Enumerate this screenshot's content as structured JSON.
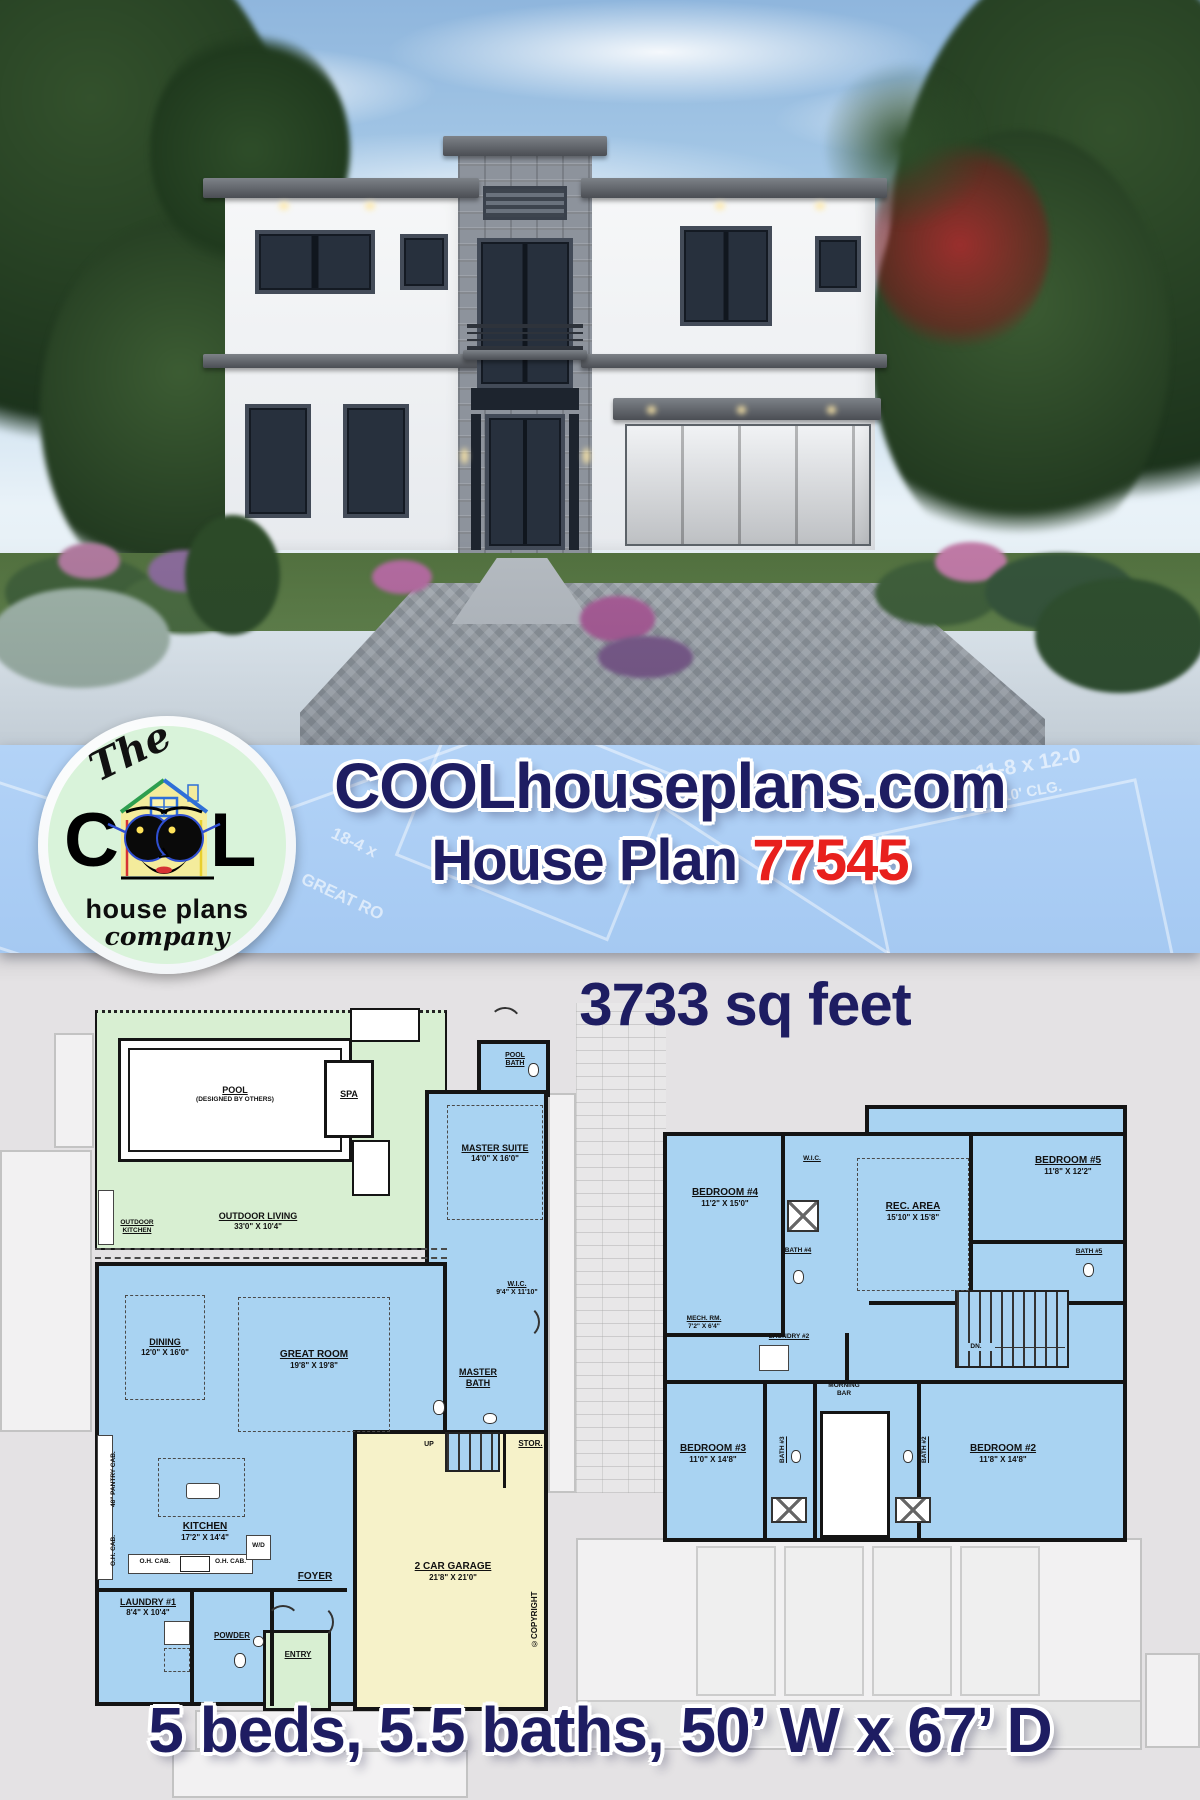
{
  "colors": {
    "navy": "#1e1d62",
    "red": "#e8201d",
    "banner_blue": "#a9ccf5",
    "room_blue": "#a9d3f2",
    "outdoor_green": "#d8efd2",
    "garage_yellow": "#f6f2c9",
    "background_gray": "#e2e0e2",
    "logo_green": "#d9f3da"
  },
  "banner": {
    "site_title": "COOLhouseplans.com",
    "plan_prefix": "House Plan",
    "plan_number": "77545",
    "logo": {
      "the": "The",
      "c": "C",
      "l": "L",
      "line2": "house plans",
      "line3": "company",
      "registered": "®"
    },
    "watermarks": [
      "11-8 x 12-0",
      "10' CLG.",
      "18-4 x",
      "HT.",
      "GREAT RO"
    ]
  },
  "plans": {
    "sqft": "3733 sq feet",
    "footer": "5 beds, 5.5 baths, 50’ W x 67’ D"
  },
  "floor1": {
    "pool": "POOL",
    "pool_note": "(DESIGNED BY OTHERS)",
    "spa": "SPA",
    "outdoor_kitchen_1": "OUTDOOR",
    "outdoor_kitchen_2": "KITCHEN",
    "outdoor_living": "OUTDOOR LIVING",
    "outdoor_living_dims": "33'0\" X 10'4\"",
    "master_suite": "MASTER SUITE",
    "master_suite_dims": "14'0\" X 16'0\"",
    "pool_bath_1": "POOL",
    "pool_bath_2": "BATH",
    "wic": "W.I.C.",
    "wic_dims": "9'4\" X 11'10\"",
    "master_bath_1": "MASTER",
    "master_bath_2": "BATH",
    "dining": "DINING",
    "dining_dims": "12'0\" X 16'0\"",
    "great_room": "GREAT ROOM",
    "great_room_dims": "19'8\" X 19'8\"",
    "kitchen": "KITCHEN",
    "kitchen_dims": "17'2\" X 14'4\"",
    "laundry1": "LAUNDRY #1",
    "laundry1_dims": "8'4\" X 10'4\"",
    "powder": "POWDER",
    "foyer": "FOYER",
    "entry": "ENTRY",
    "stor": "STOR.",
    "up": "UP",
    "wd": "W/D",
    "oh_cab": "O.H. CAB.",
    "pantry_cab": "48\" PANTRY CAB.",
    "garage": "2 CAR GARAGE",
    "garage_dims": "21'8\" X 21'0\"",
    "copyright": "©COPYRIGHT"
  },
  "floor2": {
    "bedroom4": "BEDROOM #4",
    "bedroom4_dims": "11'2\" X 15'0\"",
    "wic": "W.I.C.",
    "bath4": "BATH #4",
    "mech_rm": "MECH. RM.",
    "mech_rm_dims": "7'2\" X 6'4\"",
    "laundry2": "LAUNDRY #2",
    "rec_area": "REC. AREA",
    "rec_area_dims": "15'10\" X 15'8\"",
    "bedroom5": "BEDROOM #5",
    "bedroom5_dims": "11'8\" X 12'2\"",
    "bath5": "BATH #5",
    "dn": "DN.",
    "morning_1": "MORNING",
    "morning_2": "BAR",
    "bedroom3": "BEDROOM #3",
    "bedroom3_dims": "11'0\" X 14'8\"",
    "bath3": "BATH #3",
    "bath2": "BATH #2",
    "bedroom2": "BEDROOM #2",
    "bedroom2_dims": "11'8\" X 14'8\""
  }
}
